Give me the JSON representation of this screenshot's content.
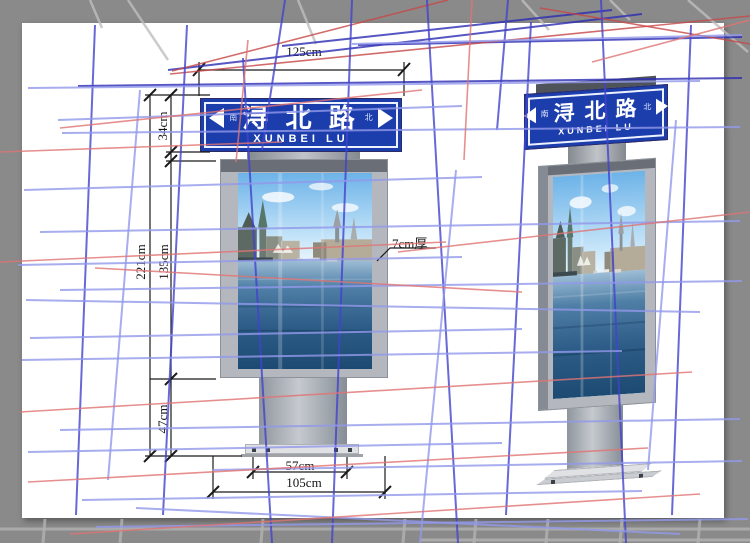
{
  "sign": {
    "name_cn": "浔 北 路",
    "name_en": "XUNBEI LU",
    "dir_left": "南",
    "dir_right": "北"
  },
  "dimensions": {
    "top_width": "125cm",
    "overall_height": "221cm",
    "header_height": "34cm",
    "box_height": "135cm",
    "base_height": "47cm",
    "column_width": "57cm",
    "base_width": "105cm",
    "thickness_note": "7cm厚"
  },
  "colors": {
    "background": "#8a8a8a",
    "canvas": "#ffffff",
    "sign_blue": "#1c3ead",
    "frame_gray": "#b4b8be",
    "dimension_ink": "#1a1a1a",
    "wire_blue": "#4343cd",
    "wire_periwinkle": "#9299ea",
    "wire_red": "#e07474"
  },
  "overlay": {
    "lines": [
      [
        128,
        0,
        168,
        60,
        "#bfbfbf",
        2.5
      ],
      [
        298,
        0,
        316,
        44,
        "#bfbfbf",
        2.5
      ],
      [
        90,
        0,
        102,
        28,
        "#bfbfbf",
        2.5
      ],
      [
        522,
        0,
        549,
        30,
        "#bfbfbf",
        2.5
      ],
      [
        688,
        0,
        748,
        52,
        "#bfbfbf",
        2.5
      ],
      [
        610,
        0,
        630,
        20,
        "#bfbfbf",
        2.5
      ],
      [
        0,
        529,
        750,
        529,
        "#b2b2b2",
        3
      ],
      [
        45,
        519,
        43,
        543,
        "#b2b2b2",
        3
      ],
      [
        122,
        519,
        120,
        543,
        "#b2b2b2",
        3
      ],
      [
        263,
        519,
        261,
        543,
        "#b2b2b2",
        3
      ],
      [
        405,
        519,
        403,
        543,
        "#b2b2b2",
        3
      ],
      [
        476,
        519,
        474,
        543,
        "#b2b2b2",
        3
      ],
      [
        548,
        519,
        546,
        543,
        "#b2b2b2",
        3
      ],
      [
        622,
        519,
        620,
        543,
        "#b2b2b2",
        3
      ],
      [
        700,
        519,
        698,
        543,
        "#b2b2b2",
        3
      ],
      [
        420,
        540,
        750,
        540,
        "#b2b2b2",
        3
      ],
      [
        168,
        70,
        642,
        14,
        "#2d2db4",
        2
      ],
      [
        282,
        46,
        612,
        10,
        "#2d2db4",
        2
      ],
      [
        78,
        86,
        742,
        78,
        "#2d2db4",
        2
      ],
      [
        358,
        45,
        742,
        37,
        "#2d2db4",
        2
      ],
      [
        170,
        74,
        750,
        16,
        "#c84848",
        1.6
      ],
      [
        540,
        8,
        750,
        44,
        "#c84848",
        1.6
      ],
      [
        448,
        0,
        172,
        71,
        "#c84848",
        1.6
      ],
      [
        95,
        25,
        76,
        515,
        "#4343cd",
        2
      ],
      [
        187,
        25,
        163,
        515,
        "#4343cd",
        2
      ],
      [
        243,
        58,
        272,
        543,
        "#4343cd",
        2
      ],
      [
        352,
        0,
        332,
        543,
        "#4343cd",
        2
      ],
      [
        427,
        0,
        458,
        543,
        "#4343cd",
        2
      ],
      [
        531,
        22,
        506,
        515,
        "#4343cd",
        2
      ],
      [
        601,
        0,
        626,
        543,
        "#4343cd",
        2
      ],
      [
        691,
        25,
        672,
        515,
        "#4343cd",
        2
      ],
      [
        285,
        0,
        262,
        150,
        "#4343cd",
        2
      ],
      [
        508,
        0,
        497,
        130,
        "#4343cd",
        2
      ],
      [
        28,
        88,
        700,
        81,
        "#9299ea",
        2
      ],
      [
        58,
        120,
        462,
        106,
        "#9299ea",
        2
      ],
      [
        62,
        133,
        740,
        127,
        "#9299ea",
        2
      ],
      [
        24,
        190,
        482,
        177,
        "#9299ea",
        2
      ],
      [
        40,
        232,
        740,
        221,
        "#9299ea",
        2
      ],
      [
        18,
        265,
        462,
        257,
        "#9299ea",
        2
      ],
      [
        26,
        300,
        700,
        312,
        "#9299ea",
        2
      ],
      [
        60,
        290,
        742,
        281,
        "#9299ea",
        2
      ],
      [
        30,
        338,
        522,
        329,
        "#9299ea",
        2
      ],
      [
        22,
        360,
        622,
        351,
        "#9299ea",
        2
      ],
      [
        60,
        430,
        740,
        419,
        "#9299ea",
        2
      ],
      [
        28,
        452,
        502,
        443,
        "#9299ea",
        2
      ],
      [
        212,
        470,
        742,
        461,
        "#9299ea",
        2
      ],
      [
        82,
        500,
        642,
        491,
        "#9299ea",
        2
      ],
      [
        352,
        44,
        742,
        35,
        "#9299ea",
        2
      ],
      [
        96,
        527,
        748,
        519,
        "#9299ea",
        2
      ],
      [
        136,
        508,
        680,
        534,
        "#9299ea",
        2
      ],
      [
        140,
        90,
        108,
        480,
        "#9299ea",
        2
      ],
      [
        456,
        170,
        420,
        543,
        "#9299ea",
        2
      ],
      [
        676,
        120,
        648,
        470,
        "#9299ea",
        2
      ],
      [
        60,
        128,
        422,
        90,
        "#e07474",
        1.6
      ],
      [
        0,
        152,
        282,
        142,
        "#e07474",
        1.6
      ],
      [
        0,
        262,
        446,
        242,
        "#e07474",
        1.6
      ],
      [
        398,
        252,
        750,
        212,
        "#e07474",
        1.6
      ],
      [
        95,
        268,
        522,
        292,
        "#e07474",
        1.6
      ],
      [
        20,
        412,
        692,
        372,
        "#e07474",
        1.6
      ],
      [
        70,
        534,
        700,
        494,
        "#e07474",
        1.6
      ],
      [
        592,
        62,
        750,
        20,
        "#e07474",
        1.6
      ],
      [
        472,
        0,
        464,
        160,
        "#e07474",
        1.6
      ],
      [
        248,
        40,
        236,
        162,
        "#e07474",
        1.6
      ],
      [
        28,
        482,
        648,
        448,
        "#e07474",
        1.6
      ]
    ]
  }
}
